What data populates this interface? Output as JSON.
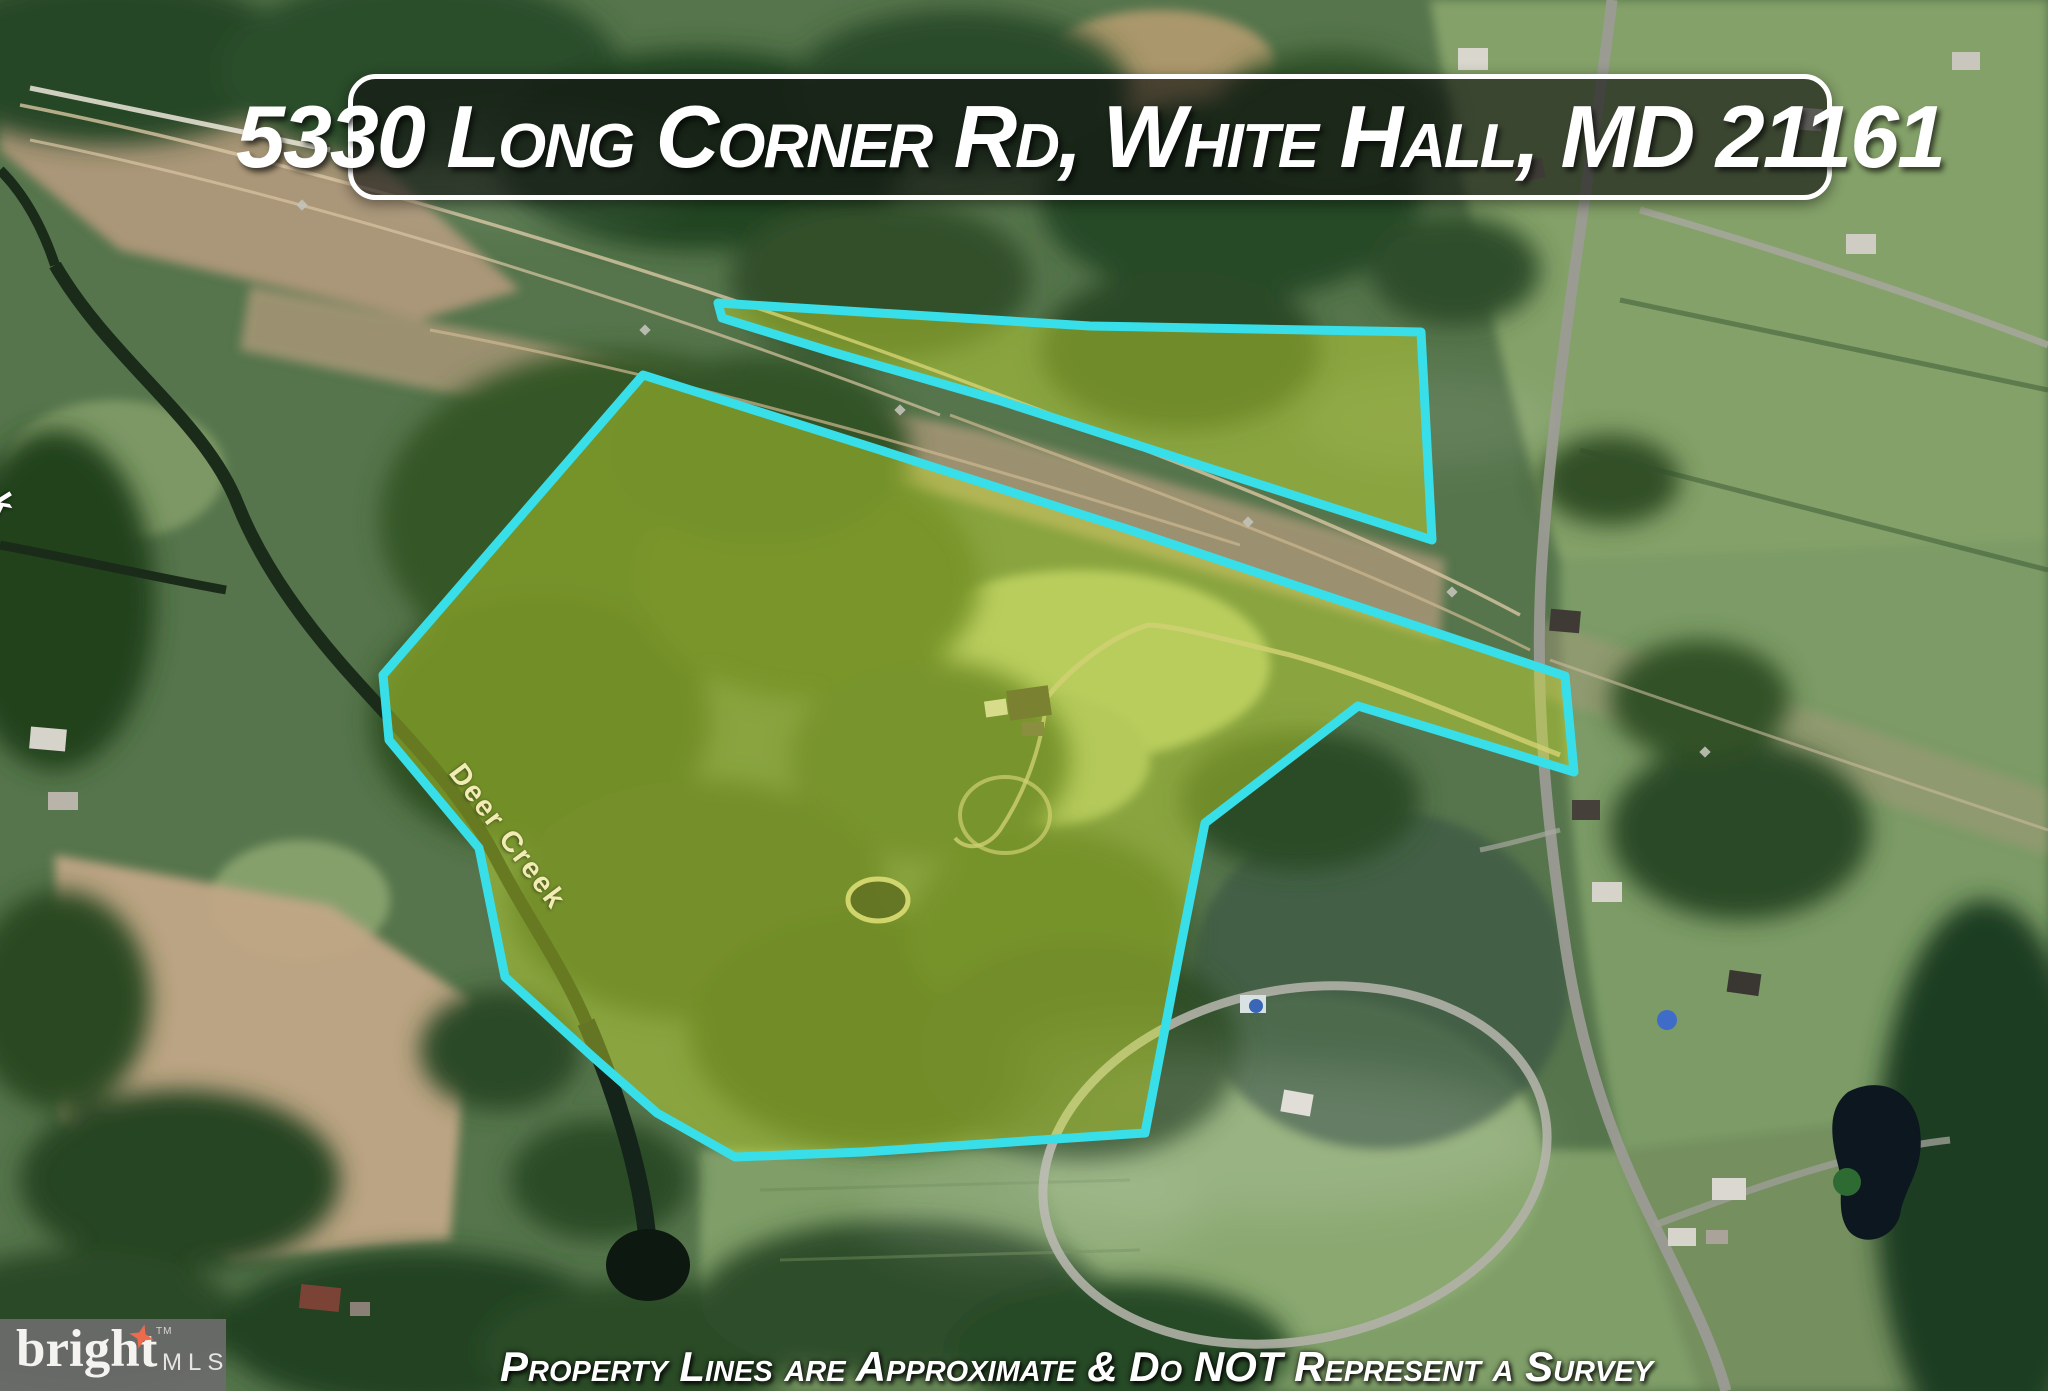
{
  "header": {
    "address_title": "5330 Long Corner Rd, White Hall, MD 21161"
  },
  "map_labels": {
    "creek_main": "Deer Creek",
    "creek_edge": "er Creek"
  },
  "property_overlay": {
    "main_parcel_points": "643,375 880,450 1130,530 1565,676 1574,772 1358,706 1205,823 1180,950 1145,1133 863,1152 735,1157 657,1113 593,1057 505,977 479,848 389,740 383,675",
    "north_strip_points": "718,303 1090,326 1421,332 1432,540 998,400 832,352 722,318"
  },
  "footer": {
    "watermark": {
      "brand": "bright",
      "tm": "TM",
      "suffix": "MLS"
    },
    "disclaimer": "Property Lines are Approximate & Do NOT Represent a Survey"
  },
  "colors": {
    "boundary-stroke": "#38dfe9",
    "parcel-fill": "rgba(210,232,48,0.42)",
    "banner-bg": "rgba(14,14,14,0.62)",
    "banner-border": "#ffffff",
    "banner-text": "#ffffff",
    "creek-label": "#f2ecb4",
    "edge-creek-label": "#ffffff",
    "watermark-bg": "rgba(108,108,108,0.93)",
    "watermark-brand": "#f4f3ef",
    "watermark-mls": "#e6e5e1",
    "watermark-star": "#ee6a4c",
    "disclaimer-text": "#ffffff"
  }
}
